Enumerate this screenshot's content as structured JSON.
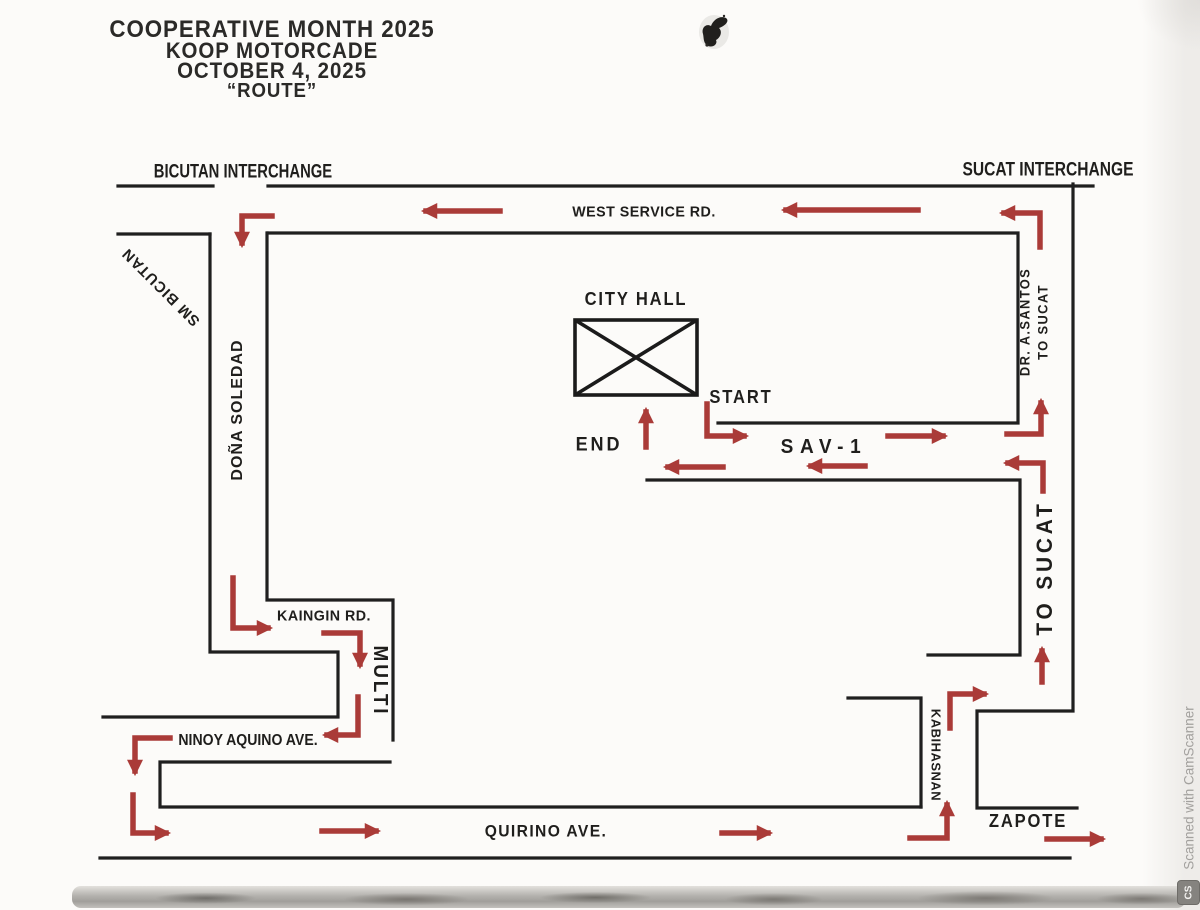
{
  "title": {
    "line1": "COOPERATIVE MONTH 2025",
    "line2": "KOOP MOTORCADE",
    "line3": "OCTOBER 4, 2025",
    "line4": "“ROUTE”"
  },
  "roads": {
    "bicutan_interchange": "BICUTAN INTERCHANGE",
    "sucat_interchange": "SUCAT INTERCHANGE",
    "west_service_rd": "WEST SERVICE RD.",
    "sm_bicutan": "SM BICUTAN",
    "dona_soledad": "DOÑA SOLEDAD",
    "dr_a_santos_line1": "DR. A.SANTOS",
    "dr_a_santos_line2": "TO SUCAT",
    "to_sucat": "TO SUCAT",
    "kaingin_rd": "KAINGIN RD.",
    "multi": "MULTI",
    "ninoy_aquino_ave": "NINOY AQUINO AVE.",
    "quirino_ave": "QUIRINO AVE.",
    "kabihasnan": "KABIHASNAN",
    "zapote": "ZAPOTE"
  },
  "landmarks": {
    "city_hall": "CITY HALL"
  },
  "route_markers": {
    "start": "START",
    "end": "END",
    "sav1": "SAV-1"
  },
  "watermark": {
    "text": "Scanned with CamScanner",
    "logo": "CS"
  },
  "colors": {
    "arrow_red": "#aa3b38",
    "road_black": "#1f1f1f",
    "text_black": "#1f1e1c",
    "watermark_gray": "#a3a19e"
  }
}
